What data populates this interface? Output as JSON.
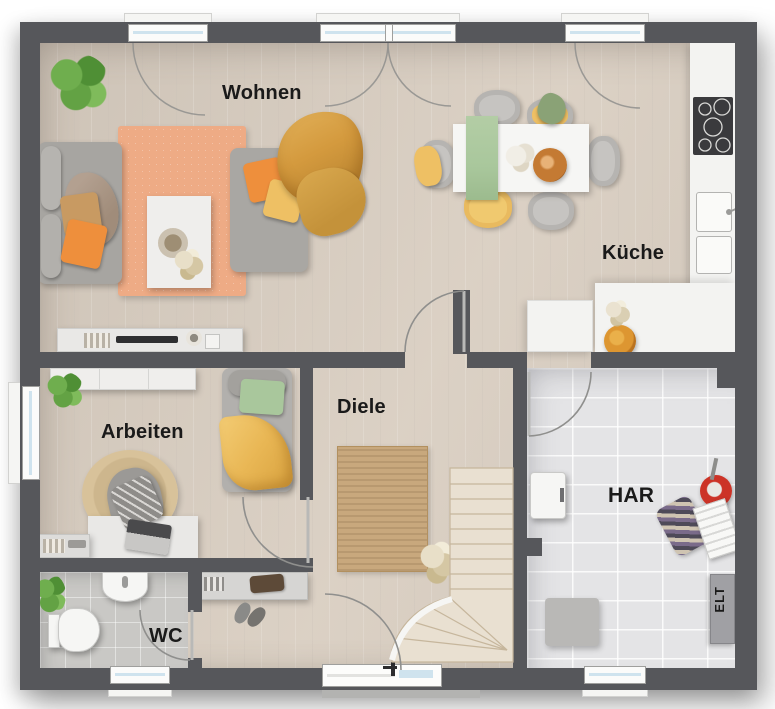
{
  "rooms": {
    "wohnen": {
      "label": "Wohnen"
    },
    "kueche": {
      "label": "Küche"
    },
    "diele": {
      "label": "Diele"
    },
    "arbeiten": {
      "label": "Arbeiten"
    },
    "wc": {
      "label": "WC"
    },
    "har": {
      "label": "HAR"
    },
    "elt": {
      "label": "ELT"
    }
  },
  "colors": {
    "wall": "#56575b",
    "wood_floor": "#d9cec1",
    "tile_wc": "#c9c8c5",
    "tile_har": "#e4e4e6",
    "counter": "#f3f3f1",
    "rug_living": "#eeab85",
    "rug_hall": "#c8a87d",
    "stair_tread": "#e9e0d1",
    "accent_orange": "#ee8f3c",
    "accent_yellow": "#eec064",
    "accent_green": "#a9c79c",
    "label_text": "#1a1a1a",
    "window_glass": "#cfe3ee"
  }
}
